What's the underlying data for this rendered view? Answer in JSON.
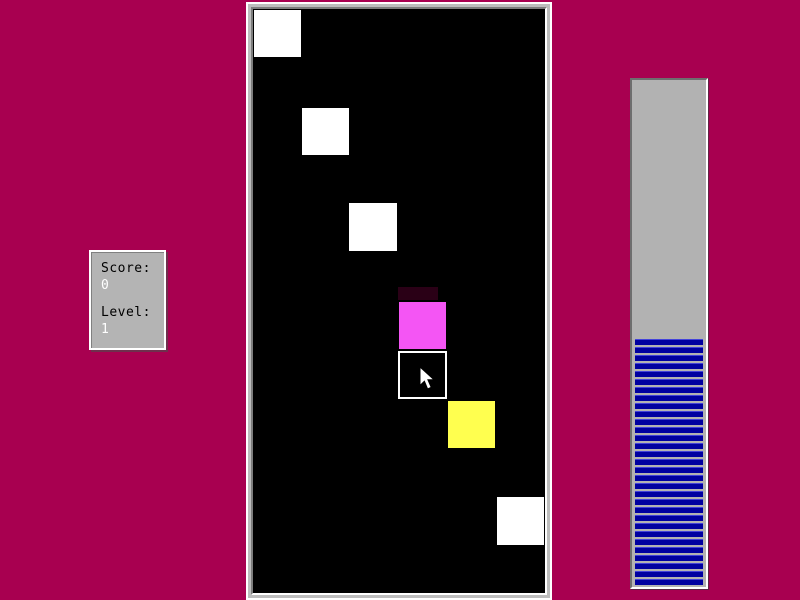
{
  "window": {
    "background_color": "#a80050"
  },
  "score_panel": {
    "score_label": "Score:",
    "score_value": "0",
    "level_label": "Level:",
    "level_value": "1",
    "panel_color": "#b4b4b4",
    "label_color": "#000000",
    "value_color": "#ffffff"
  },
  "playfield": {
    "board_color": "#000000",
    "frame_color": "#bdbdbd",
    "tiles": [
      {
        "name": "tile-white-1",
        "color": "#ffffff",
        "x": 1,
        "y": 1,
        "w": 47,
        "h": 47,
        "interactable": true
      },
      {
        "name": "tile-white-2",
        "color": "#ffffff",
        "x": 49,
        "y": 99,
        "w": 47,
        "h": 47,
        "interactable": true
      },
      {
        "name": "tile-white-3",
        "color": "#ffffff",
        "x": 96,
        "y": 194,
        "w": 48,
        "h": 48,
        "interactable": true
      },
      {
        "name": "falling-trail",
        "color": "#2a0016",
        "x": 145,
        "y": 278,
        "w": 40,
        "h": 13,
        "interactable": false
      },
      {
        "name": "tile-magenta",
        "color": "#f455f4",
        "x": 146,
        "y": 293,
        "w": 47,
        "h": 47,
        "interactable": true
      },
      {
        "name": "tile-yellow",
        "color": "#ffff4f",
        "x": 195,
        "y": 392,
        "w": 47,
        "h": 47,
        "interactable": true
      },
      {
        "name": "tile-white-4",
        "color": "#ffffff",
        "x": 244,
        "y": 488,
        "w": 47,
        "h": 48,
        "interactable": true
      }
    ],
    "selection_cell": {
      "name": "selection-cursor-cell",
      "border_color": "#ffffff",
      "x": 145,
      "y": 342,
      "w": 49,
      "h": 48
    }
  },
  "progress_bar": {
    "fill_percent": 49,
    "trough_color": "#b2b2b2",
    "stripe_color": "#0000a0",
    "stripe_highlight_color": "#4343da"
  },
  "cursor": {
    "icon": "arrow-pointer",
    "x": 419,
    "y": 366
  }
}
